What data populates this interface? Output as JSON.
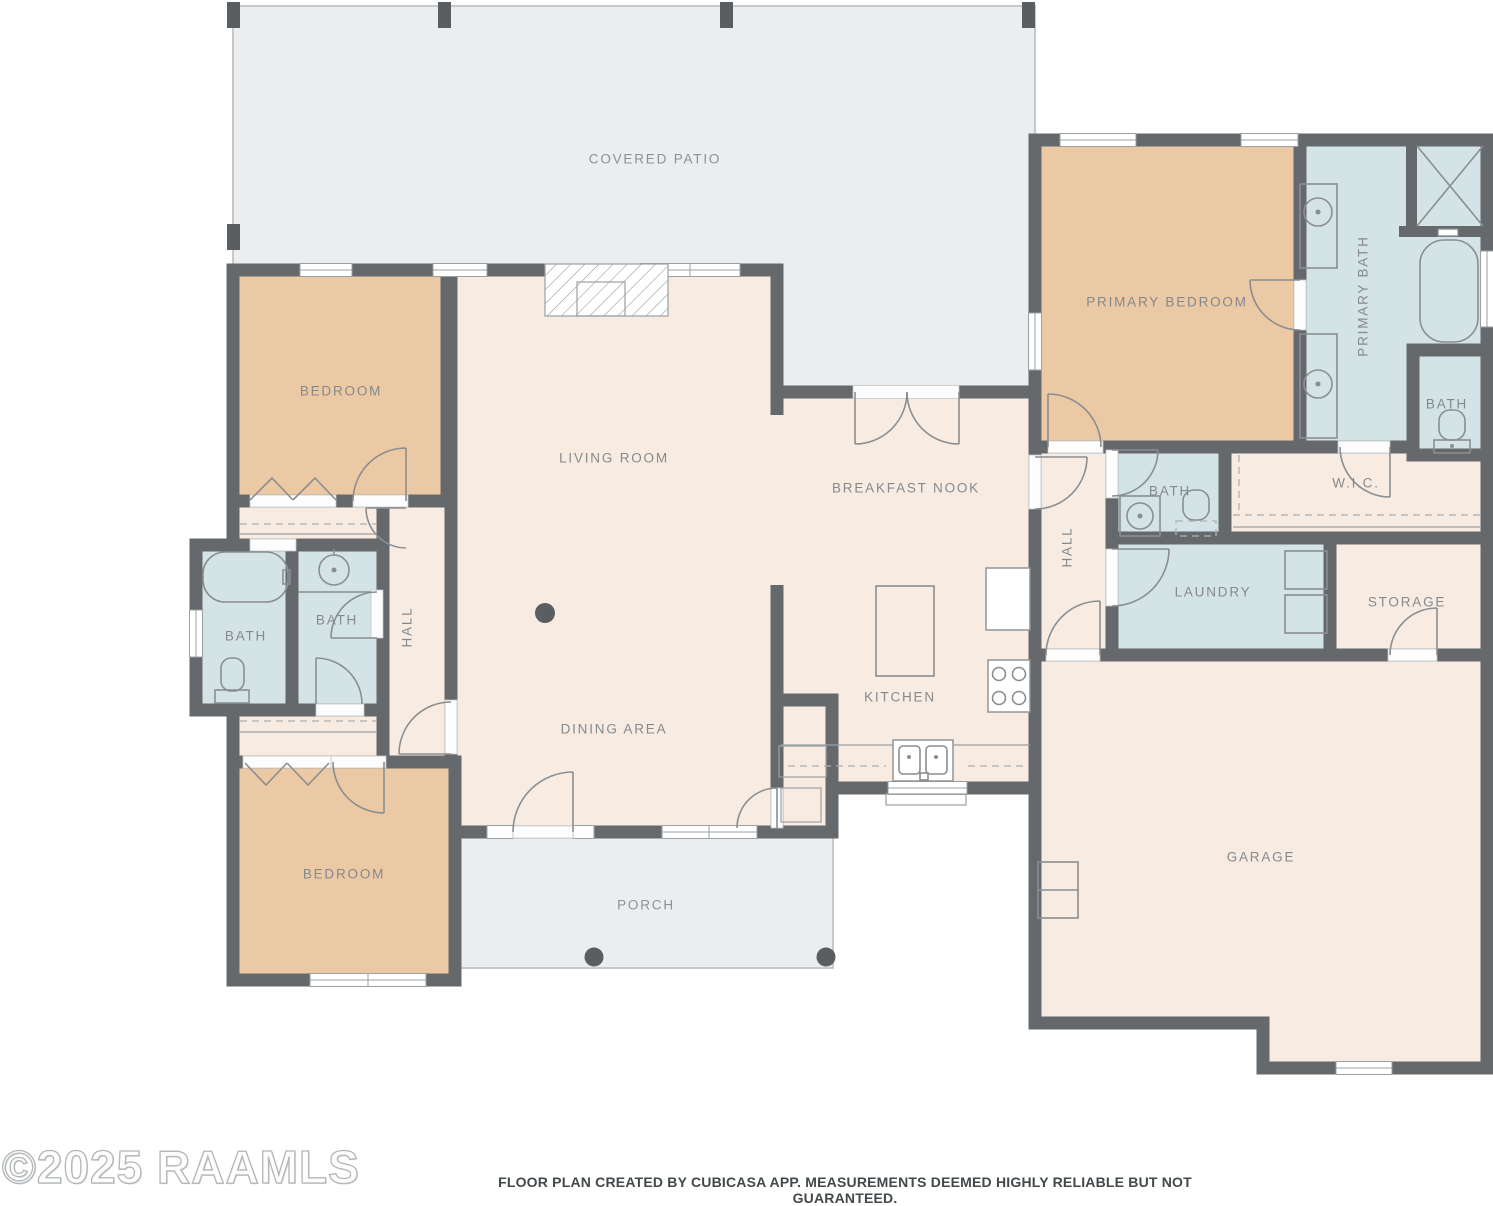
{
  "footer": {
    "watermark": "©2025 RAAMLS",
    "disclaimer": "FLOOR PLAN CREATED BY CUBICASA APP. MEASUREMENTS DEEMED HIGHLY RELIABLE BUT NOT GUARANTEED."
  },
  "colors": {
    "wall": "#66696c",
    "floor_cream": "#f8ece2",
    "floor_tan": "#ebc9a4",
    "floor_blue": "#d4e3e6",
    "outdoor_gray": "#ecedee",
    "outdoor_outline": "#c6c9cc",
    "label": "#85898c",
    "label_muted": "#8d9296",
    "fixture": "#8a8e91",
    "dashed": "#adb1b4",
    "post": "#5a5e61",
    "footer_text": "#43484b",
    "watermark_outline": "#b2b6b9"
  },
  "labels": {
    "covered_patio": "COVERED PATIO",
    "bedroom_top": "BEDROOM",
    "living_room": "LIVING ROOM",
    "dining_area": "DINING AREA",
    "breakfast_nook": "BREAKFAST NOOK",
    "kitchen": "KITCHEN",
    "hall_left": "HALL",
    "hall_right": "HALL",
    "bath_left": "BATH",
    "bath_inner": "BATH",
    "bath_hall": "BATH",
    "bath_primary_wc": "BATH",
    "primary_bedroom": "PRIMARY BEDROOM",
    "primary_bath": "PRIMARY BATH",
    "wic": "W.I.C.",
    "laundry": "LAUNDRY",
    "storage": "STORAGE",
    "garage": "GARAGE",
    "bedroom_bottom": "BEDROOM",
    "porch": "PORCH"
  }
}
